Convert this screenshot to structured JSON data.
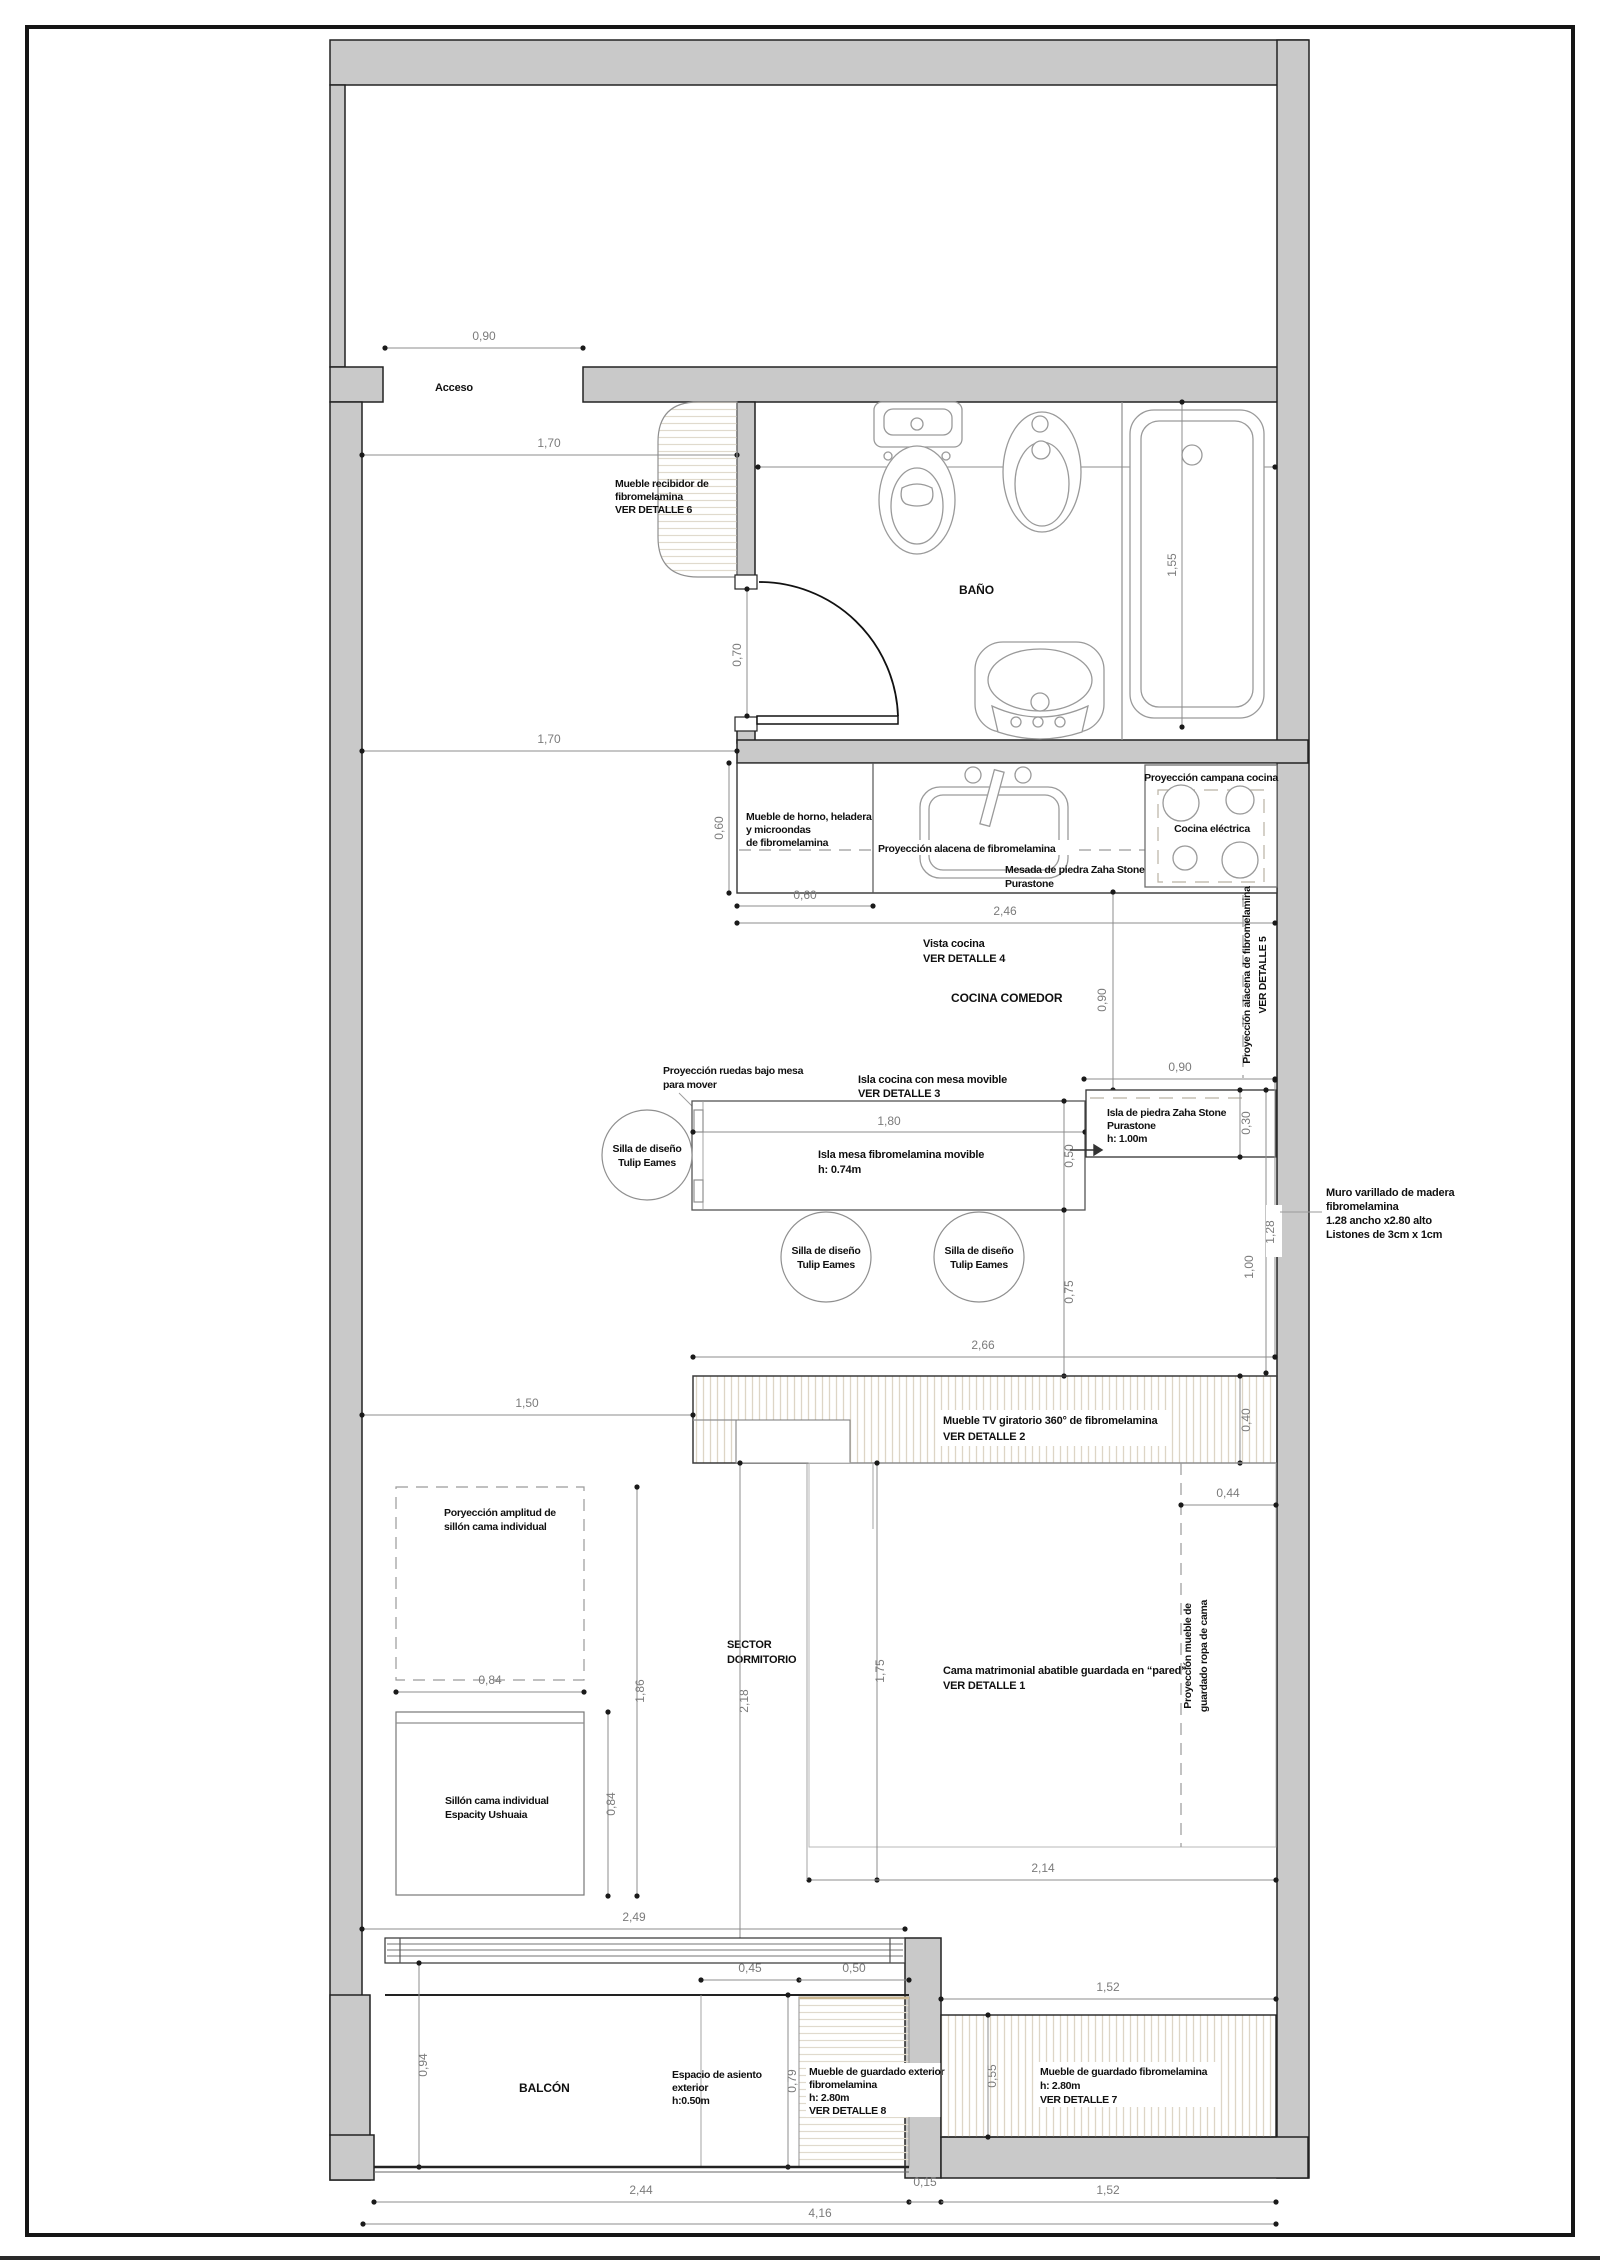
{
  "labels": {
    "acceso": "Acceso",
    "recibidor": [
      "Mueble recibidor de",
      "fibromelamina",
      "VER DETALLE 6"
    ],
    "bano": "BAÑO",
    "campana": "Proyección campana cocina",
    "cocina_electrica": "Cocina eléctrica",
    "horno": [
      "Mueble de horno, heladera",
      "y microondas",
      "de fibromelamina"
    ],
    "alacena": "Proyección alacena de fibromelamina",
    "mesada": [
      "Mesada de piedra Zaha Stone",
      "Purastone"
    ],
    "vista_cocina": [
      "Vista cocina",
      "VER DETALLE 4"
    ],
    "cocina_comedor": "COCINA COMEDOR",
    "alacena5": [
      "Proyección alacena de fibromelamina",
      "VER DETALLE 5"
    ],
    "ruedas": [
      "Proyección ruedas bajo mesa",
      "para mover"
    ],
    "isla_cocina": [
      "Isla cocina con mesa movible",
      "VER DETALLE 3"
    ],
    "isla_mesa": [
      "Isla mesa fibromelamina movible",
      "h: 0.74m"
    ],
    "isla_piedra": [
      "Isla de piedra Zaha Stone",
      "Purastone",
      "h: 1.00m"
    ],
    "silla": [
      "Silla de diseño",
      "Tulip Eames"
    ],
    "muro": [
      "Muro varillado de madera",
      "fibromelamina",
      "1.28 ancho x2.80 alto",
      "Listones de 3cm x 1cm"
    ],
    "tv": [
      "Mueble TV giratorio 360° de fibromelamina",
      "VER DETALLE 2"
    ],
    "proy_sillon": [
      "Poryección amplitud de",
      "sillón cama individual"
    ],
    "sillon": [
      "Sillón cama individual",
      "Espacity Ushuaia"
    ],
    "sector": [
      "SECTOR",
      "DORMITORIO"
    ],
    "cama": [
      "Cama matrimonial abatible guardada en “pared”",
      "VER DETALLE 1"
    ],
    "ropa": [
      "Proyección mueble de",
      "guardado ropa de cama"
    ],
    "balcon": "BALCÓN",
    "asiento": [
      "Espacio de asiento",
      "exterior",
      "h:0.50m"
    ],
    "guardado_ext": [
      "Mueble de guardado exterior",
      "fibromelamina",
      "h: 2.80m",
      "VER DETALLE 8"
    ],
    "guardado": [
      "Mueble de guardado fibromelamina",
      "h: 2.80m",
      "VER DETALLE 7"
    ]
  },
  "dims": {
    "acceso": "0,90",
    "hall_top": "1,70",
    "hall_bottom": "1,70",
    "bano_ancho": "2,37",
    "tina": "1,55",
    "puerta": "0,70",
    "horno_ancho": "0,60",
    "mesada_prof": "0,60",
    "mesada_largo": "2,46",
    "cocina_gap": "0,90",
    "isla_gap": "0,90",
    "isla_piedra_prof": "0,30",
    "isla_largo": "1,80",
    "isla_ancho": "0,50",
    "paso": "0,75",
    "isla_total": "2,66",
    "muro_seg": "1,00",
    "muro_ancho": "1,28",
    "tv_prof": "0,40",
    "sector_ancho": "1,50",
    "sillon_proy": "1,86",
    "sillon_ancho": "0,84",
    "sillon_largo": "0,84",
    "dormitorio_largo": "2,18",
    "cama_largo": "1,75",
    "ropero_prof": "0,44",
    "cama_ancho": "2,14",
    "ventana": "2,49",
    "asiento_a": "0,45",
    "asiento_b": "0,50",
    "balcon_prof": "0,94",
    "asiento_prof": "0,79",
    "guardado_top": "1,52",
    "guardado_prof": "0,55",
    "balcon_largo": "2,44",
    "muro_quince": "0,15",
    "guardado_largo": "1,52",
    "total": "4,16"
  },
  "colors": {
    "wall": "#c9c9c9",
    "dim_text": "#7b7b7b",
    "label_text": "#101010",
    "hatch": "#ddd5c6"
  }
}
